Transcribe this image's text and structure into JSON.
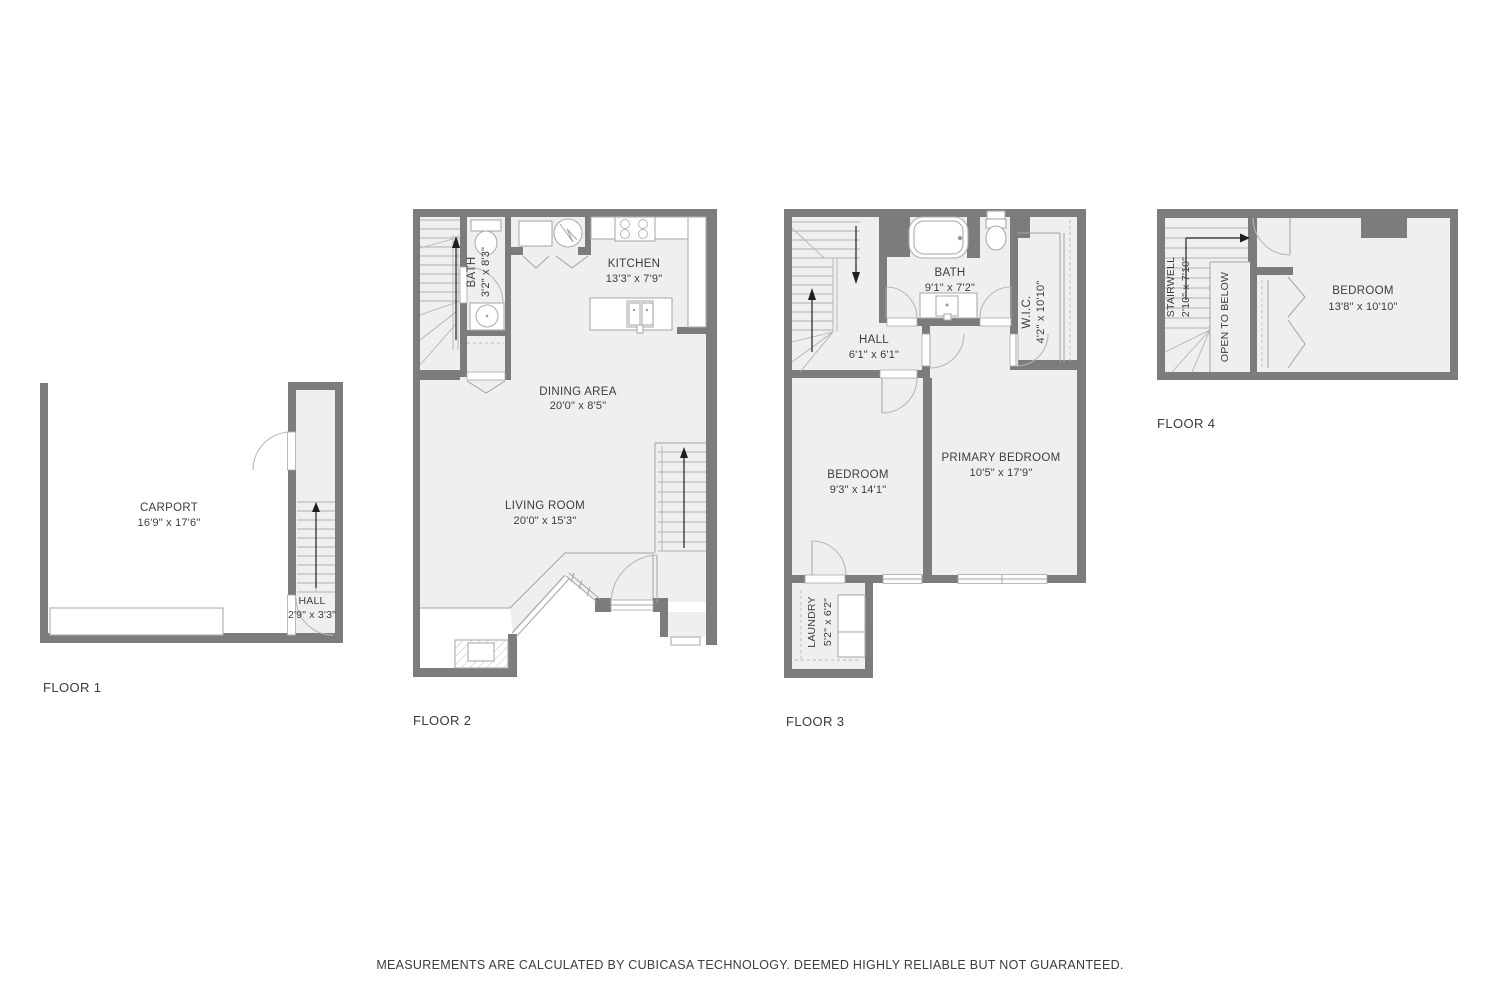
{
  "disclaimer": "MEASUREMENTS ARE CALCULATED BY CUBICASA TECHNOLOGY. DEEMED HIGHLY RELIABLE BUT NOT GUARANTEED.",
  "floors": [
    {
      "label": "FLOOR 1",
      "rooms": [
        {
          "name": "CARPORT",
          "dims": "16'9\" x 17'6\""
        },
        {
          "name": "HALL",
          "dims": "2'9\" x 3'3\""
        }
      ]
    },
    {
      "label": "FLOOR 2",
      "rooms": [
        {
          "name": "BATH",
          "dims": "3'2\" x 8'3\""
        },
        {
          "name": "KITCHEN",
          "dims": "13'3\" x 7'9\""
        },
        {
          "name": "DINING AREA",
          "dims": "20'0\" x 8'5\""
        },
        {
          "name": "LIVING ROOM",
          "dims": "20'0\" x 15'3\""
        }
      ]
    },
    {
      "label": "FLOOR 3",
      "rooms": [
        {
          "name": "HALL",
          "dims": "6'1\" x 6'1\""
        },
        {
          "name": "BATH",
          "dims": "9'1\" x 7'2\""
        },
        {
          "name": "W.I.C.",
          "dims": "4'2\" x 10'10\""
        },
        {
          "name": "BEDROOM",
          "dims": "9'3\" x 14'1\""
        },
        {
          "name": "PRIMARY BEDROOM",
          "dims": "10'5\" x 17'9\""
        },
        {
          "name": "LAUNDRY",
          "dims": "5'2\" x 6'2\""
        }
      ]
    },
    {
      "label": "FLOOR 4",
      "rooms": [
        {
          "name": "STAIRWELL",
          "dims": "2'10\" x 7'10\""
        },
        {
          "name": "OPEN TO BELOW",
          "dims": ""
        },
        {
          "name": "BEDROOM",
          "dims": "13'8\" x 10'10\""
        }
      ]
    }
  ]
}
